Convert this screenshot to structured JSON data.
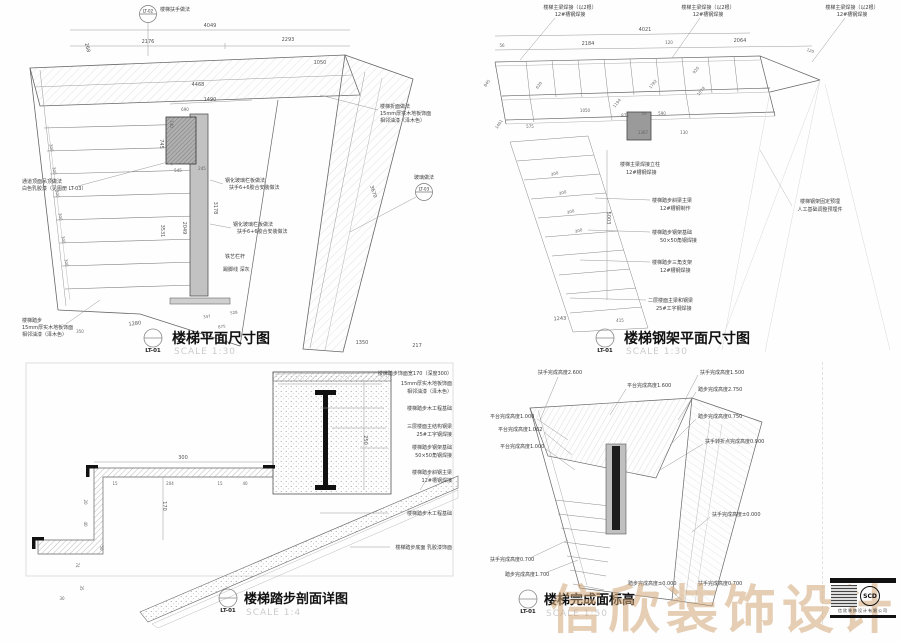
{
  "watermark": "信欣装饰设计",
  "logo": {
    "brand": "SCD",
    "company": "信欣装饰设计有限公司"
  },
  "panels": {
    "plan": {
      "title": "楼梯平面尺寸图",
      "ref": "LT-01",
      "scale": "SCALE 1:30",
      "bubble_top_ref": "LT-02",
      "bubble_top_label": "楼梯扶手做法",
      "bubble_right_ref": "LT-03",
      "bubble_right_label": "玻璃做法",
      "notes": {
        "ceiling": [
          "通道顶面吊顶做法",
          "白色乳胶漆（见图册 LT-03）"
        ],
        "tread": [
          "楼梯踏步",
          "15mm厚实木地板饰面",
          "相邻油漆（泽木色）"
        ],
        "landing": [
          "楼梯折面做法",
          "15mm厚实木地板饰面",
          "相邻油漆（泽木色）"
        ],
        "rail1": [
          "钢化玻璃栏板做法",
          "扶手6+6胶合安装做法"
        ],
        "rail2": [
          "钢化玻璃栏板做法",
          "扶手6+6胶合安装做法"
        ],
        "iron": "铁艺栏杆",
        "skirt": "踢脚线 深灰"
      },
      "dims": [
        "4049",
        "2176",
        "2293",
        "4468",
        "1050",
        "268",
        "1490",
        "690",
        "140",
        "545",
        "245",
        "745",
        "3178",
        "2049",
        "3531",
        "300",
        "1280",
        "350",
        "347",
        "528",
        "875",
        "1350",
        "217",
        "3670"
      ]
    },
    "steel": {
      "title": "楼梯钢架平面尺寸图",
      "ref": "LT-01",
      "scale": "SCALE 1:30",
      "notes": {
        "beam_top": [
          "楼梯主梁焊接（以2根）",
          "12#槽钢焊接"
        ],
        "embed": [
          "楼梯钢架固定预埋",
          "人工基础调整预埋件"
        ],
        "column": [
          "楼梯主梁焊接立柱",
          "12#槽钢焊接"
        ],
        "side": [
          [
            "楼梯踏步斜梁主梁",
            "12#槽钢制作"
          ],
          [
            "楼梯踏步钢架基础",
            "50×50角钢焊接"
          ],
          [
            "楼梯踏步三角支架",
            "12#槽钢焊接"
          ],
          [
            "二层楼面主梁和钢梁",
            "25#工字钢焊接"
          ]
        ]
      },
      "dims": [
        "4021",
        "56",
        "2184",
        "120",
        "2064",
        "120",
        "875",
        "59",
        "590",
        "1367",
        "130",
        "1782",
        "1074",
        "920",
        "1194",
        "845",
        "620",
        "575",
        "1050",
        "1401",
        "5003",
        "300",
        "1243",
        "415"
      ]
    },
    "section": {
      "title": "楼梯踏步剖面详图",
      "ref": "LT-01",
      "scale": "SCALE 1:4",
      "notes": [
        [
          "楼梯踏步饰面宽170（深度300）"
        ],
        [
          "15mm厚实木地板饰面",
          "相邻油漆（泽木色）"
        ],
        [
          "楼梯踏步木工程基础"
        ],
        [
          "三层楼面主结构钢梁",
          "25#工字钢焊接"
        ],
        [
          "楼梯踏步钢架基础",
          "50×50角钢焊接"
        ],
        [
          "楼梯踏步斜钢主梁",
          "12#槽钢焊接"
        ],
        [
          "楼梯踏步木工程基础"
        ],
        [
          "楼梯踏步底面 乳胶漆饰面"
        ]
      ],
      "dims": [
        "300",
        "170",
        "15",
        "204",
        "15",
        "40",
        "20",
        "40",
        "50",
        "74",
        "35",
        "30",
        "250"
      ]
    },
    "elevation": {
      "title": "楼梯完成面标高",
      "ref": "LT-01",
      "scale": "SCALE 1:50",
      "labels": {
        "top": "扶手完成高度2.600",
        "top_right": "平台完成高度1.600",
        "left": [
          "平台完成高度1.000",
          "平台完成高度1.002",
          "平台完成高度1.000"
        ],
        "right": [
          "扶手完成高度1.500",
          "踏步完成高度2.750",
          "踏步完成高度0.750",
          "扶手转折点完成高度0.900",
          "扶手完成高度±0.000"
        ],
        "bottom": [
          "扶手完成高度0.700",
          "踏步完成高度1.700",
          "踏步完成高度±0.000",
          "扶手完成高度0.700"
        ]
      }
    }
  }
}
